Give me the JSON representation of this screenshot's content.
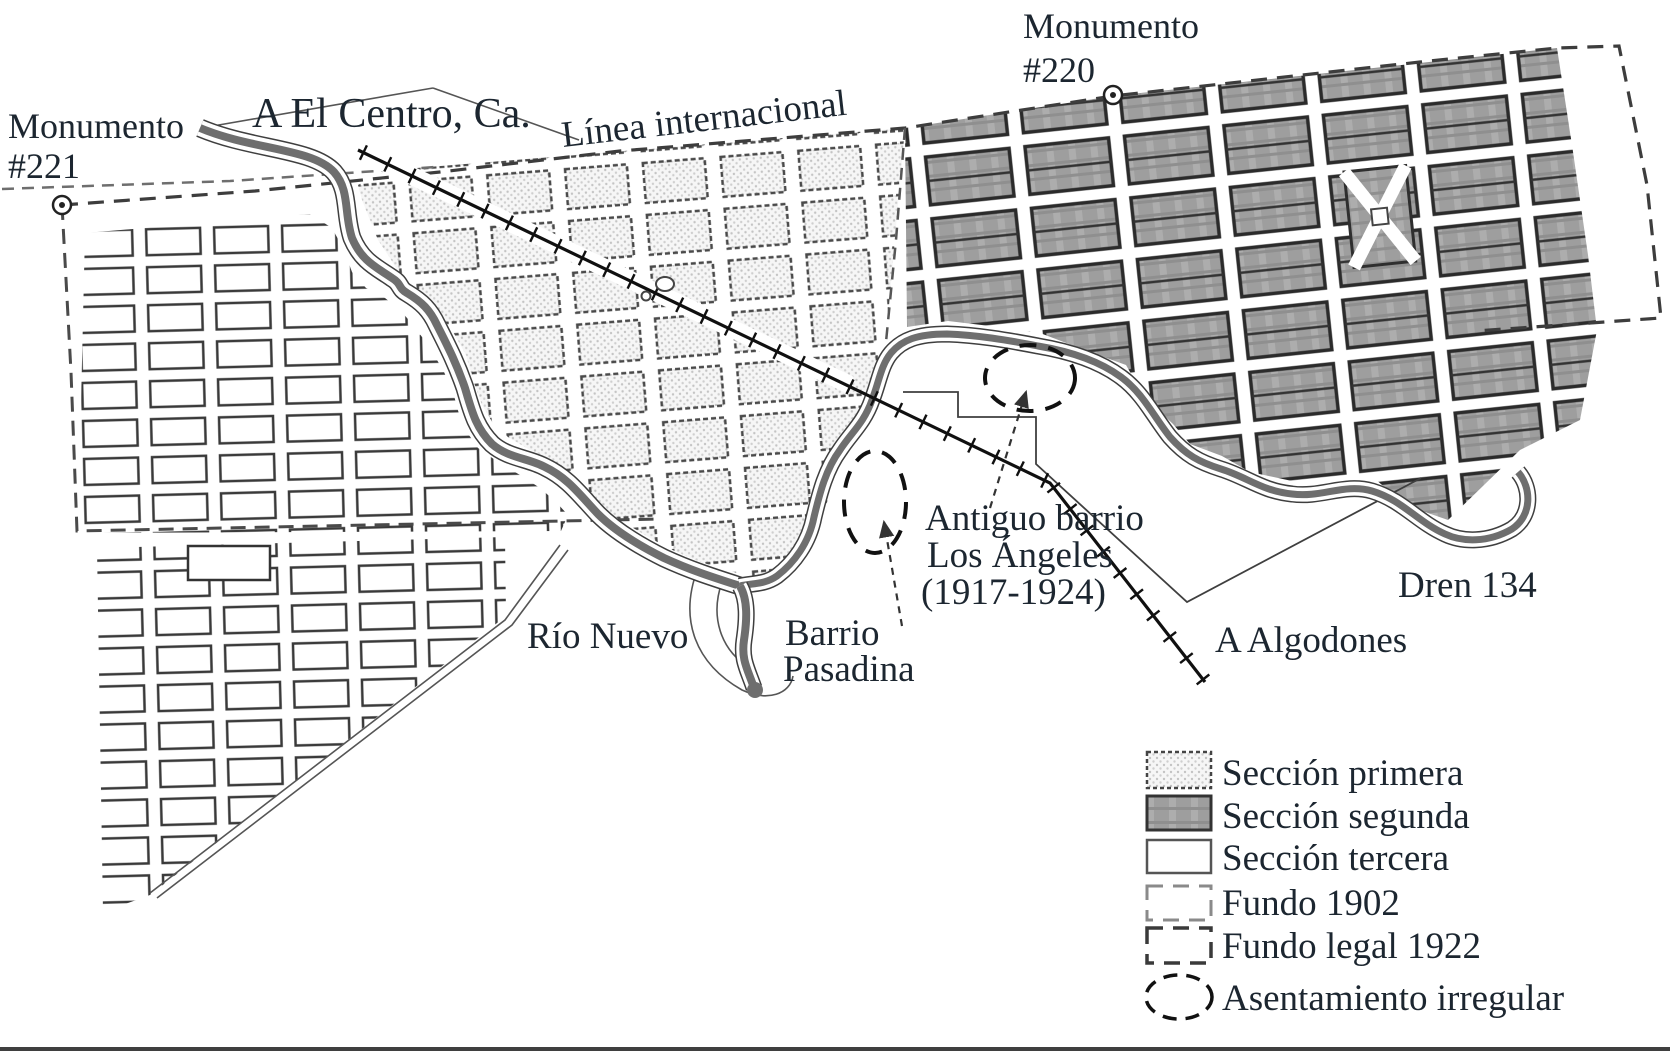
{
  "labels": {
    "monumento_221_1": "Monumento",
    "monumento_221_2": "#221",
    "monumento_220_1": "Monumento",
    "monumento_220_2": "#220",
    "a_el_centro": "A El Centro, Ca.",
    "linea_internacional": "Línea internacional",
    "rio_nuevo": "Río Nuevo",
    "barrio_pasadina_1": "Barrio",
    "barrio_pasadina_2": "Pasadina",
    "antiguo_barrio_1": "Antiguo barrio",
    "antiguo_barrio_2": "Los Ángeles",
    "antiguo_barrio_3": "(1917-1924)",
    "a_algodones": "A Algodones",
    "dren_134": "Dren 134"
  },
  "legend": {
    "items": [
      {
        "label": "Sección primera",
        "swatch": "dotted-block"
      },
      {
        "label": "Sección segunda",
        "swatch": "gray-block"
      },
      {
        "label": "Sección tercera",
        "swatch": "outline-block"
      },
      {
        "label": "Fundo 1902",
        "swatch": "dashed-light-rect"
      },
      {
        "label": "Fundo legal 1922",
        "swatch": "dashed-dark-rect"
      },
      {
        "label": "Asentamiento irregular",
        "swatch": "dashed-ellipse"
      }
    ]
  },
  "icons": {
    "monument_marker": "circled-dot",
    "railroad": "ticked-line",
    "irregular_settlement": "dashed-ellipse"
  },
  "colors": {
    "ink": "#1c2630",
    "water": "#6e6e6e",
    "section_gray": "#9e9e9e",
    "paper": "#ffffff",
    "boundary_dash": "#3d3d3d"
  }
}
